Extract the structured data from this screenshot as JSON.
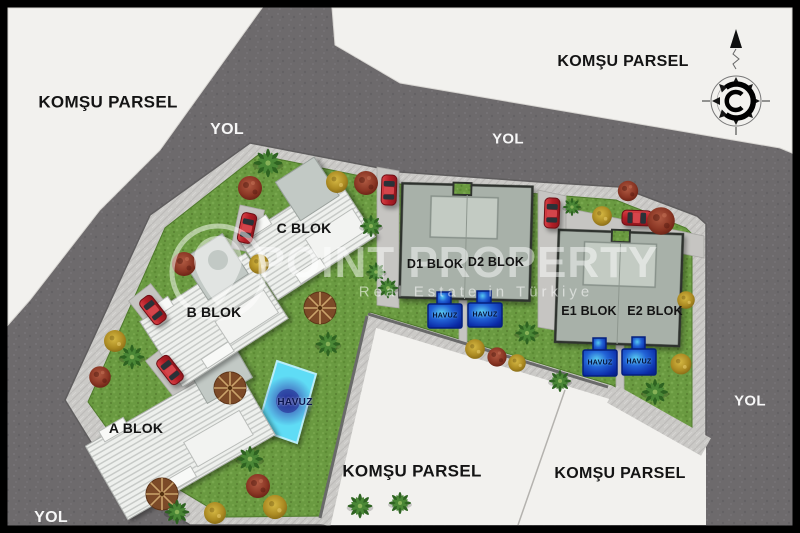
{
  "labels": {
    "neighbor_parcel": "KOMŞU PARSEL",
    "road": "YOL",
    "pool": "HAVUZ",
    "blocks": {
      "a": "A BLOK",
      "b": "B BLOK",
      "c": "C BLOK",
      "d1": "D1 BLOK",
      "d2": "D2 BLOK",
      "e1": "E1 BLOK",
      "e2": "E2 BLOK"
    }
  },
  "watermark": {
    "title": "POINT PROPERTY",
    "subtitle": "Real Estate in Türkiye"
  },
  "icons": {
    "compass": "compass-north-icon",
    "logo": "location-pin-icon"
  },
  "colors": {
    "road": "#6d6a6c",
    "parcel": "#f2f1ee",
    "sidewalk": "#cbcac7",
    "grass": "#6a9a41",
    "building_light": "#eef0ed",
    "building_sage": "#a8b1a9",
    "pool_small": "#0a2aa6",
    "pool_large": "#5fdcf5",
    "car": "#c22a32"
  }
}
